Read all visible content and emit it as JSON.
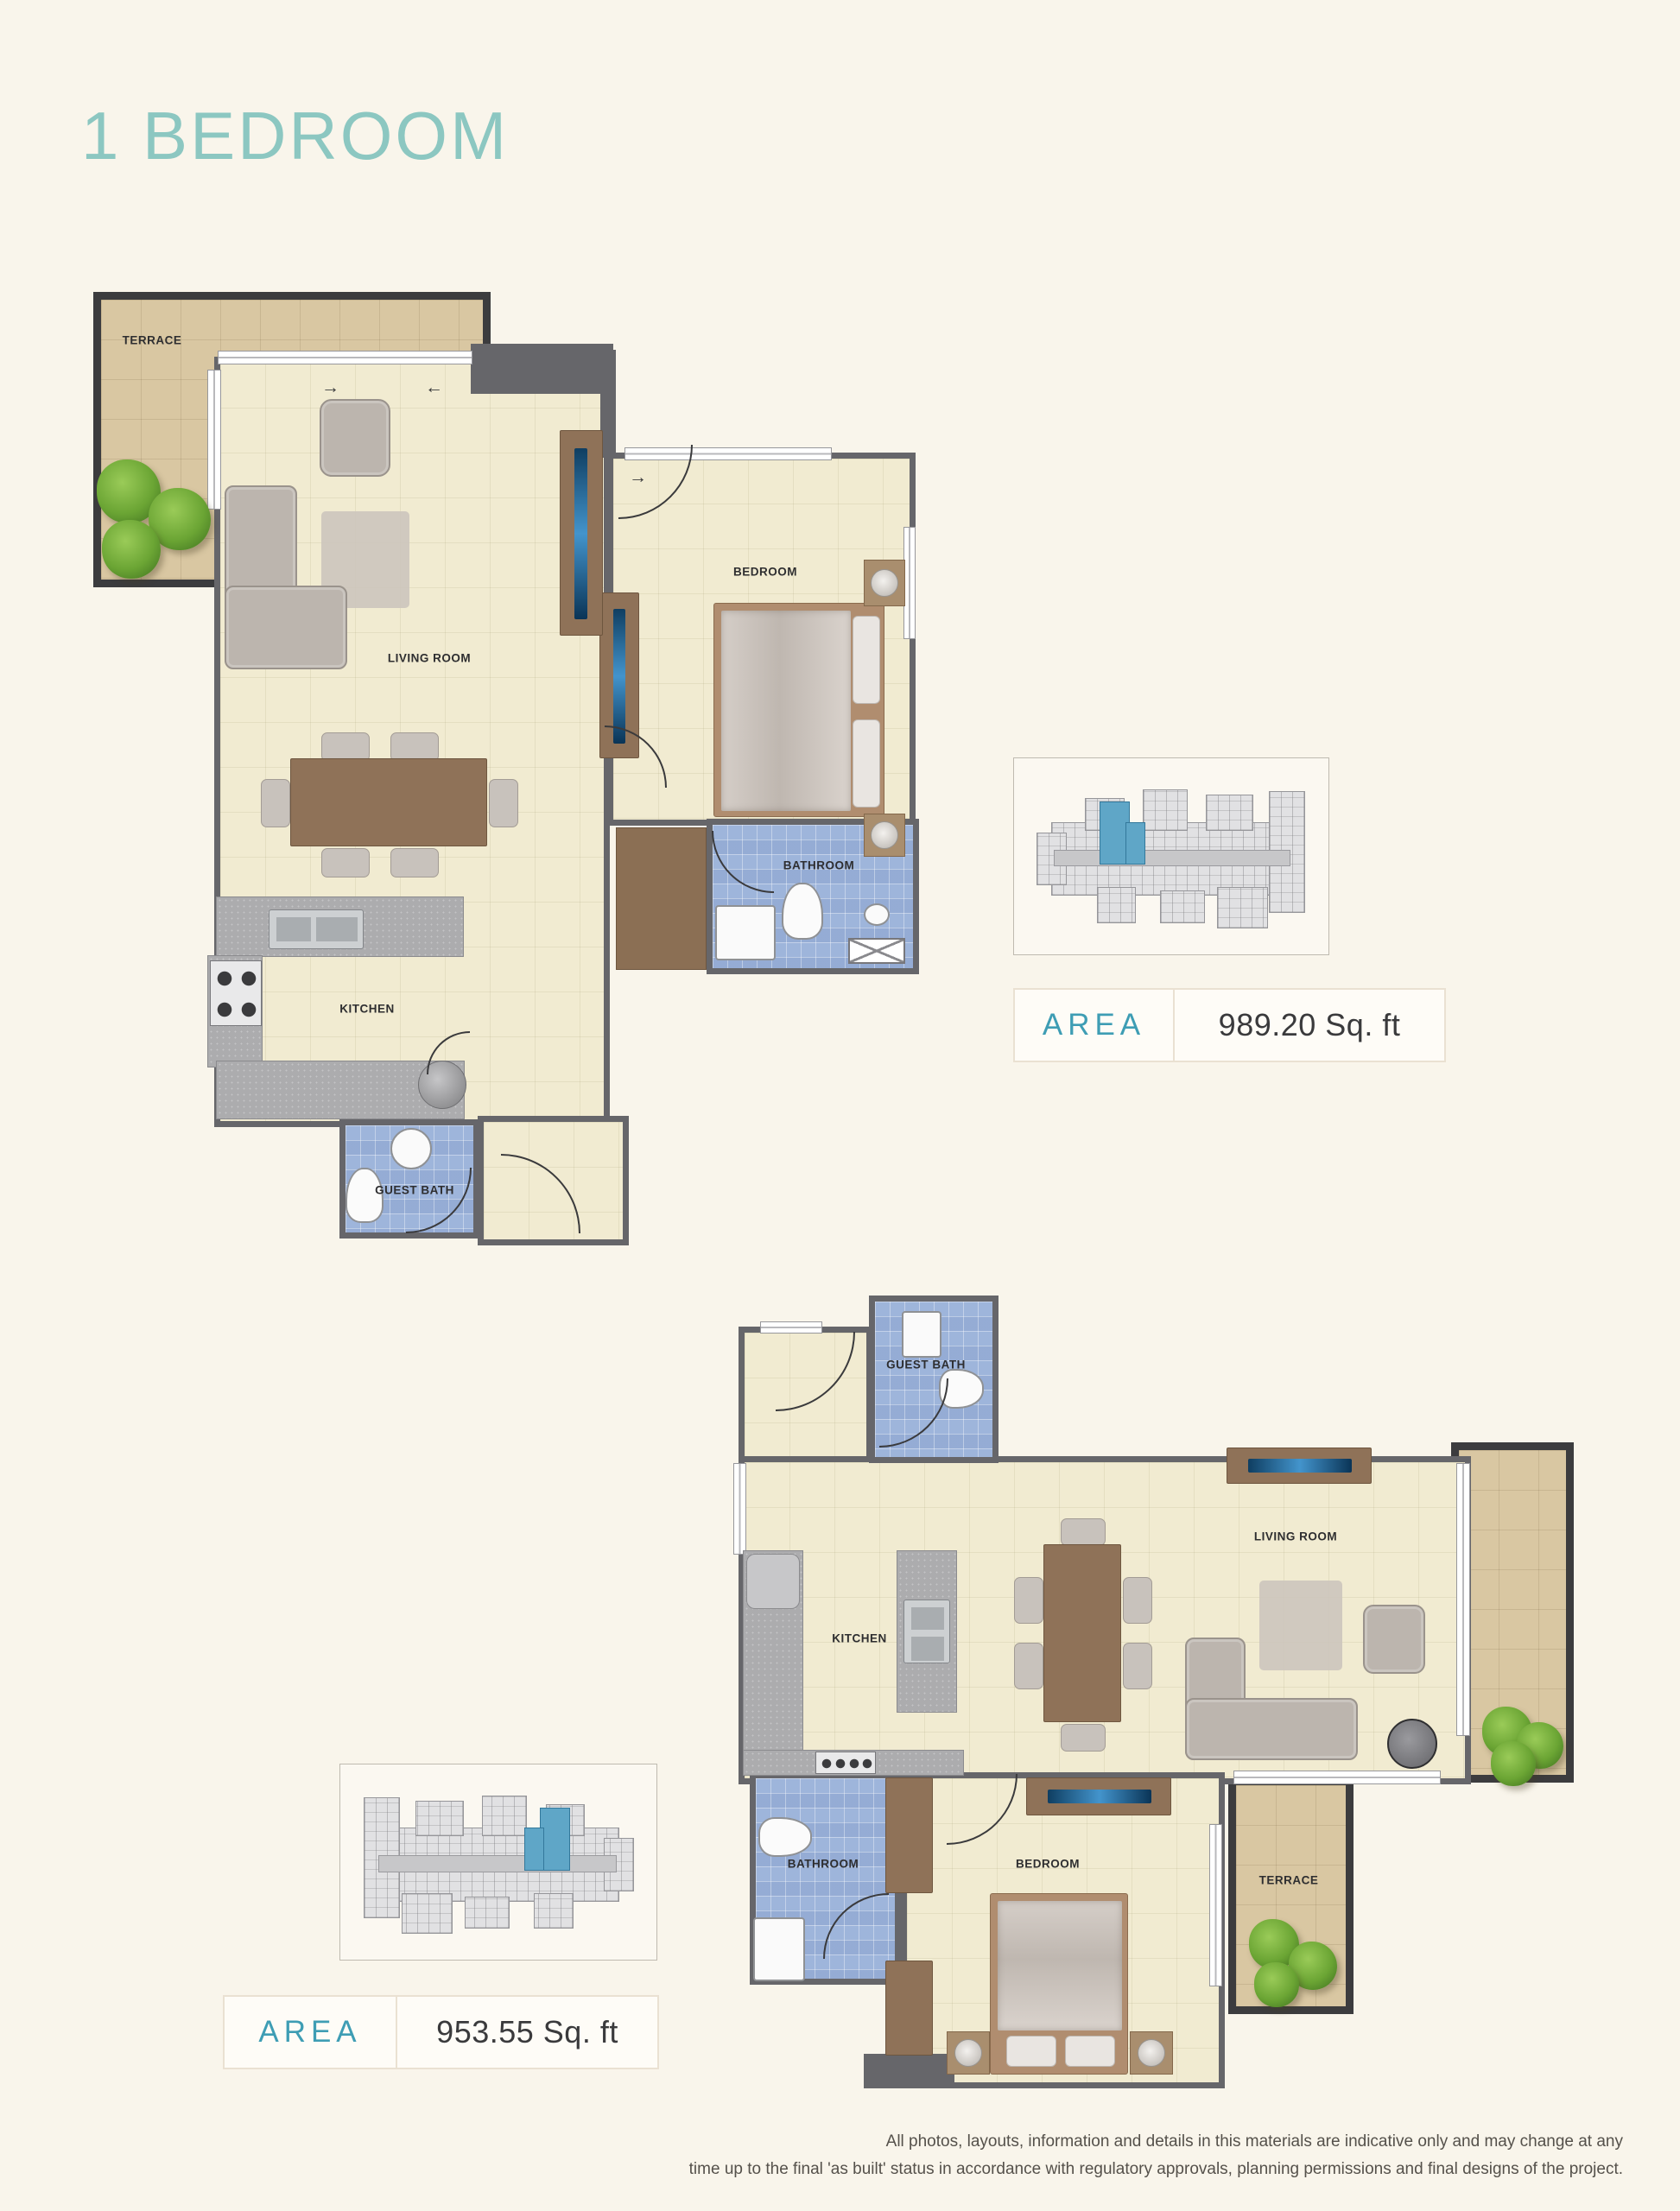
{
  "page": {
    "title": "1 BEDROOM",
    "background_color": "#F9F5EB",
    "title_color": "#8CC7C1"
  },
  "units": [
    {
      "name": "unit-top",
      "area_label": "AREA",
      "area_value": "989.20 Sq. ft",
      "rooms": {
        "terrace": "TERRACE",
        "living_room": "LIVING ROOM",
        "bedroom": "BEDROOM",
        "bathroom": "BATHROOM",
        "kitchen": "KITCHEN",
        "guest_bath": "GUEST BATH"
      }
    },
    {
      "name": "unit-bottom",
      "area_label": "AREA",
      "area_value": "953.55 Sq. ft",
      "rooms": {
        "terrace": "TERRACE",
        "living_room": "LIVING ROOM",
        "bedroom": "BEDROOM",
        "bathroom": "BATHROOM",
        "kitchen": "KITCHEN",
        "guest_bath": "GUEST BATH"
      }
    }
  ],
  "icons": {
    "airflow_right": "→",
    "airflow_left": "←"
  },
  "colors": {
    "area_label": "#3E9DB4",
    "interior_wall": "#66666A",
    "terrace_wall": "#3C3C3E",
    "floor": "#F1EBD1",
    "terrace_floor": "#D9C7A2",
    "bath_tile": "#9EB5DB",
    "keyplan_highlight": "#5FA6C7"
  },
  "disclaimer": {
    "line1": "All photos, layouts, information and details in this materials are indicative only and may change at any",
    "line2": "time up to the final 'as built' status in accordance with regulatory approvals, planning permissions and final designs of the project."
  }
}
